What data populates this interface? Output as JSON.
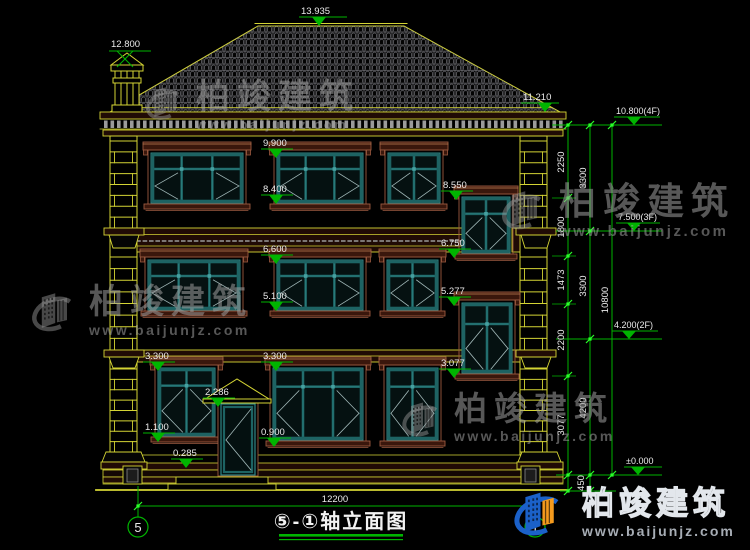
{
  "title": {
    "text": "⑤-①轴立面图"
  },
  "axes": {
    "a5": "5",
    "a1": "1"
  },
  "watermark": {
    "brand": "柏竣建筑",
    "url": "www.baijunjz.com"
  },
  "levels": {
    "ridge": "13.935",
    "chimney": "12.800",
    "eave": "11.210",
    "f4": "10.800(4F)",
    "f3": "7.500(3F)",
    "f2": "4.200(2F)",
    "zero": "±0.000"
  },
  "marks": {
    "m9900": "9.900",
    "m8400": "8.400",
    "m8550": "8.550",
    "m6750": "6.750",
    "m6600": "6.600",
    "m5100": "5.100",
    "m5277": "5.277",
    "m3300a": "3.300",
    "m3300b": "3.300",
    "m3077": "3.077",
    "m2286": "2.286",
    "m1100": "1.100",
    "m0900": "0.900",
    "m0285": "0.285"
  },
  "dims": {
    "total": "12200",
    "d2250": "2250",
    "d1800": "1800",
    "d1473": "1473",
    "d2200": "2200",
    "d3077": "3077",
    "d450": "450",
    "d3300a": "3300",
    "d3300b": "3300",
    "d4200": "4200",
    "d10800": "10800"
  },
  "colors": {
    "line": "#d4d434",
    "dim": "#00b400",
    "grip": "#2aff2a",
    "teal": "#2e8585",
    "trimS": "#9c5a40",
    "trimF": "#3a170c",
    "logoBlue": "#1b61c9",
    "logoOrange": "#f49a1d"
  }
}
